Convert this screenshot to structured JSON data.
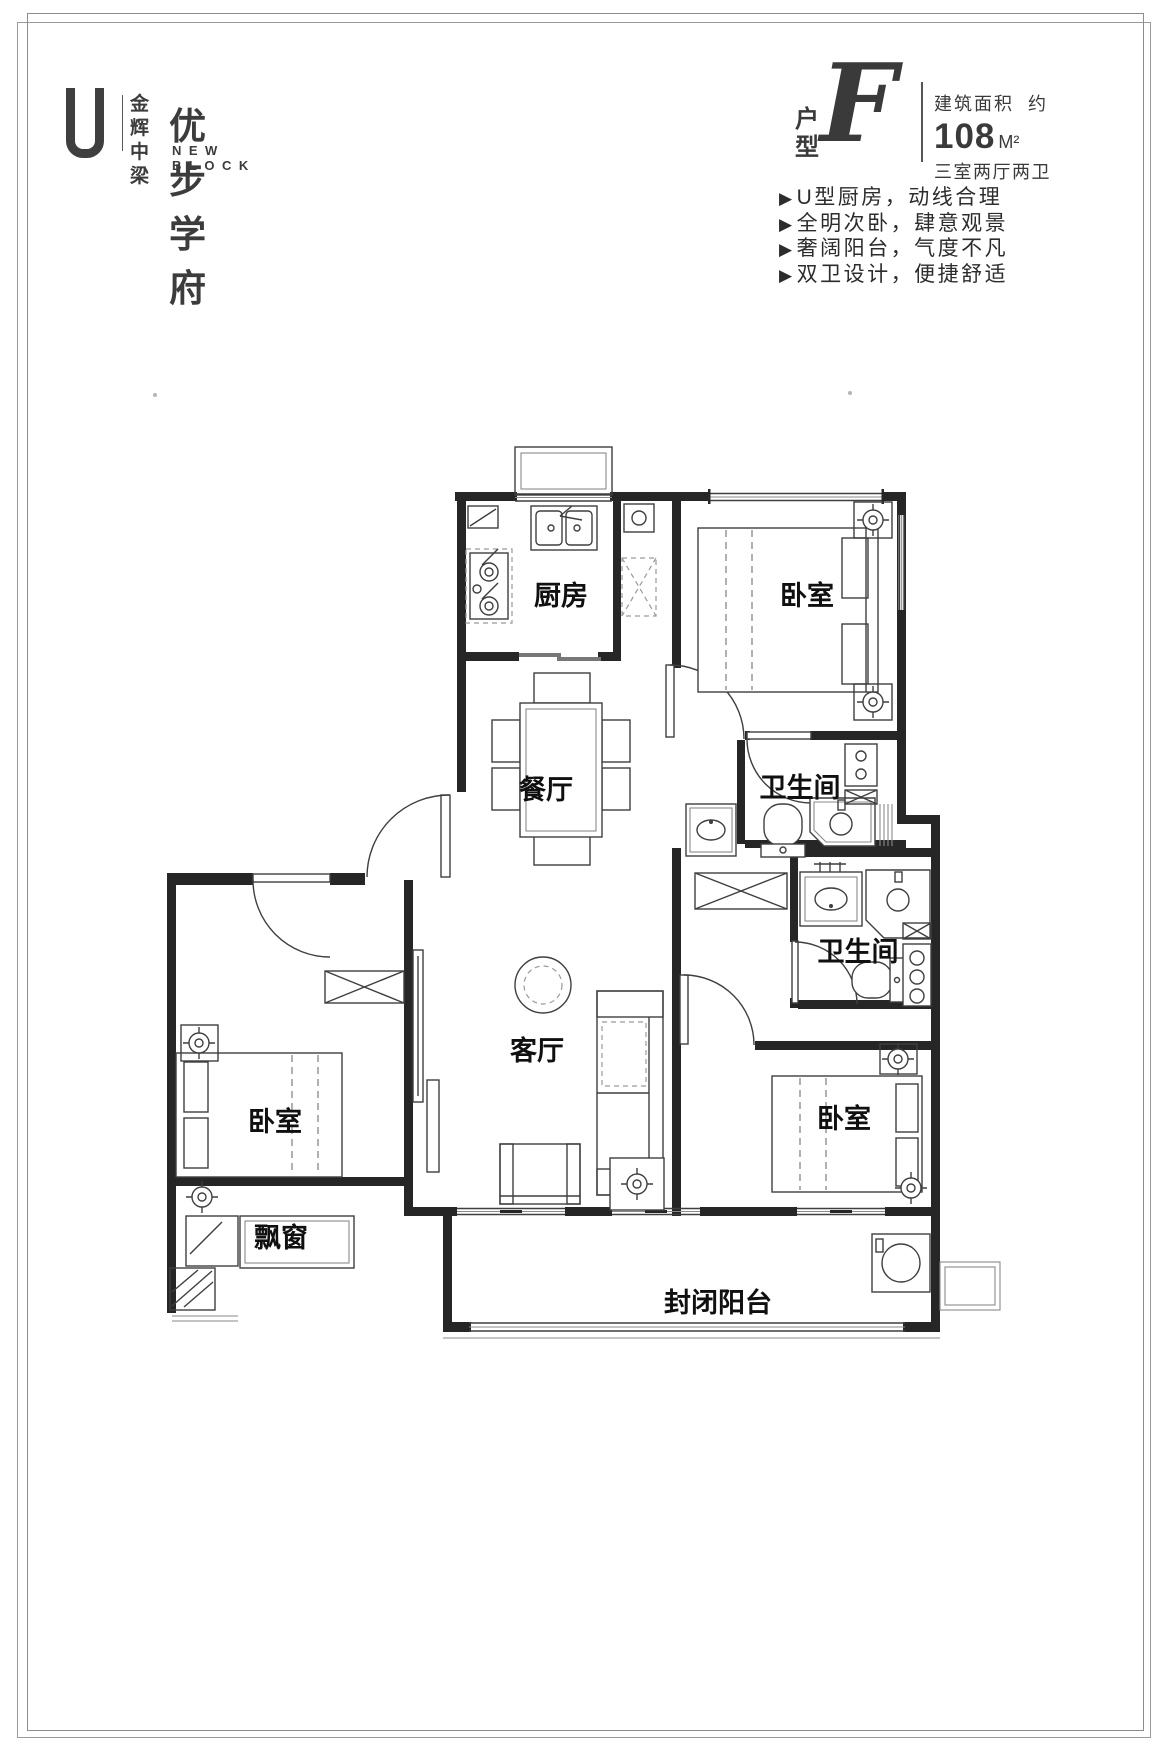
{
  "logo": {
    "brand_line1": "金辉",
    "brand_line2": "中梁",
    "name": "优步学府",
    "subtitle": "NEW BLOCK"
  },
  "unit": {
    "type_label_1": "户",
    "type_label_2": "型",
    "type_letter": "F",
    "area_label": "建筑面积",
    "area_approx": "约",
    "area_value": "108",
    "area_unit": "M²",
    "layout_desc": "三室两厅两卫"
  },
  "bullet": "▶",
  "features": [
    "U型厨房，动线合理",
    "全明次卧，肆意观景",
    "奢阔阳台，气度不凡",
    "双卫设计，便捷舒适"
  ],
  "rooms": [
    {
      "name": "厨房",
      "x": 561,
      "y": 605
    },
    {
      "name": "卧室",
      "x": 807,
      "y": 605
    },
    {
      "name": "卫生间",
      "x": 800,
      "y": 797
    },
    {
      "name": "餐厅",
      "x": 546,
      "y": 799
    },
    {
      "name": "客厅",
      "x": 537,
      "y": 1060
    },
    {
      "name": "卧室",
      "x": 275,
      "y": 1131
    },
    {
      "name": "飘窗",
      "x": 281,
      "y": 1247
    },
    {
      "name": "卫生间",
      "x": 858,
      "y": 961
    },
    {
      "name": "卧室",
      "x": 844,
      "y": 1128
    },
    {
      "name": "封闭阳台",
      "x": 718,
      "y": 1312
    }
  ]
}
